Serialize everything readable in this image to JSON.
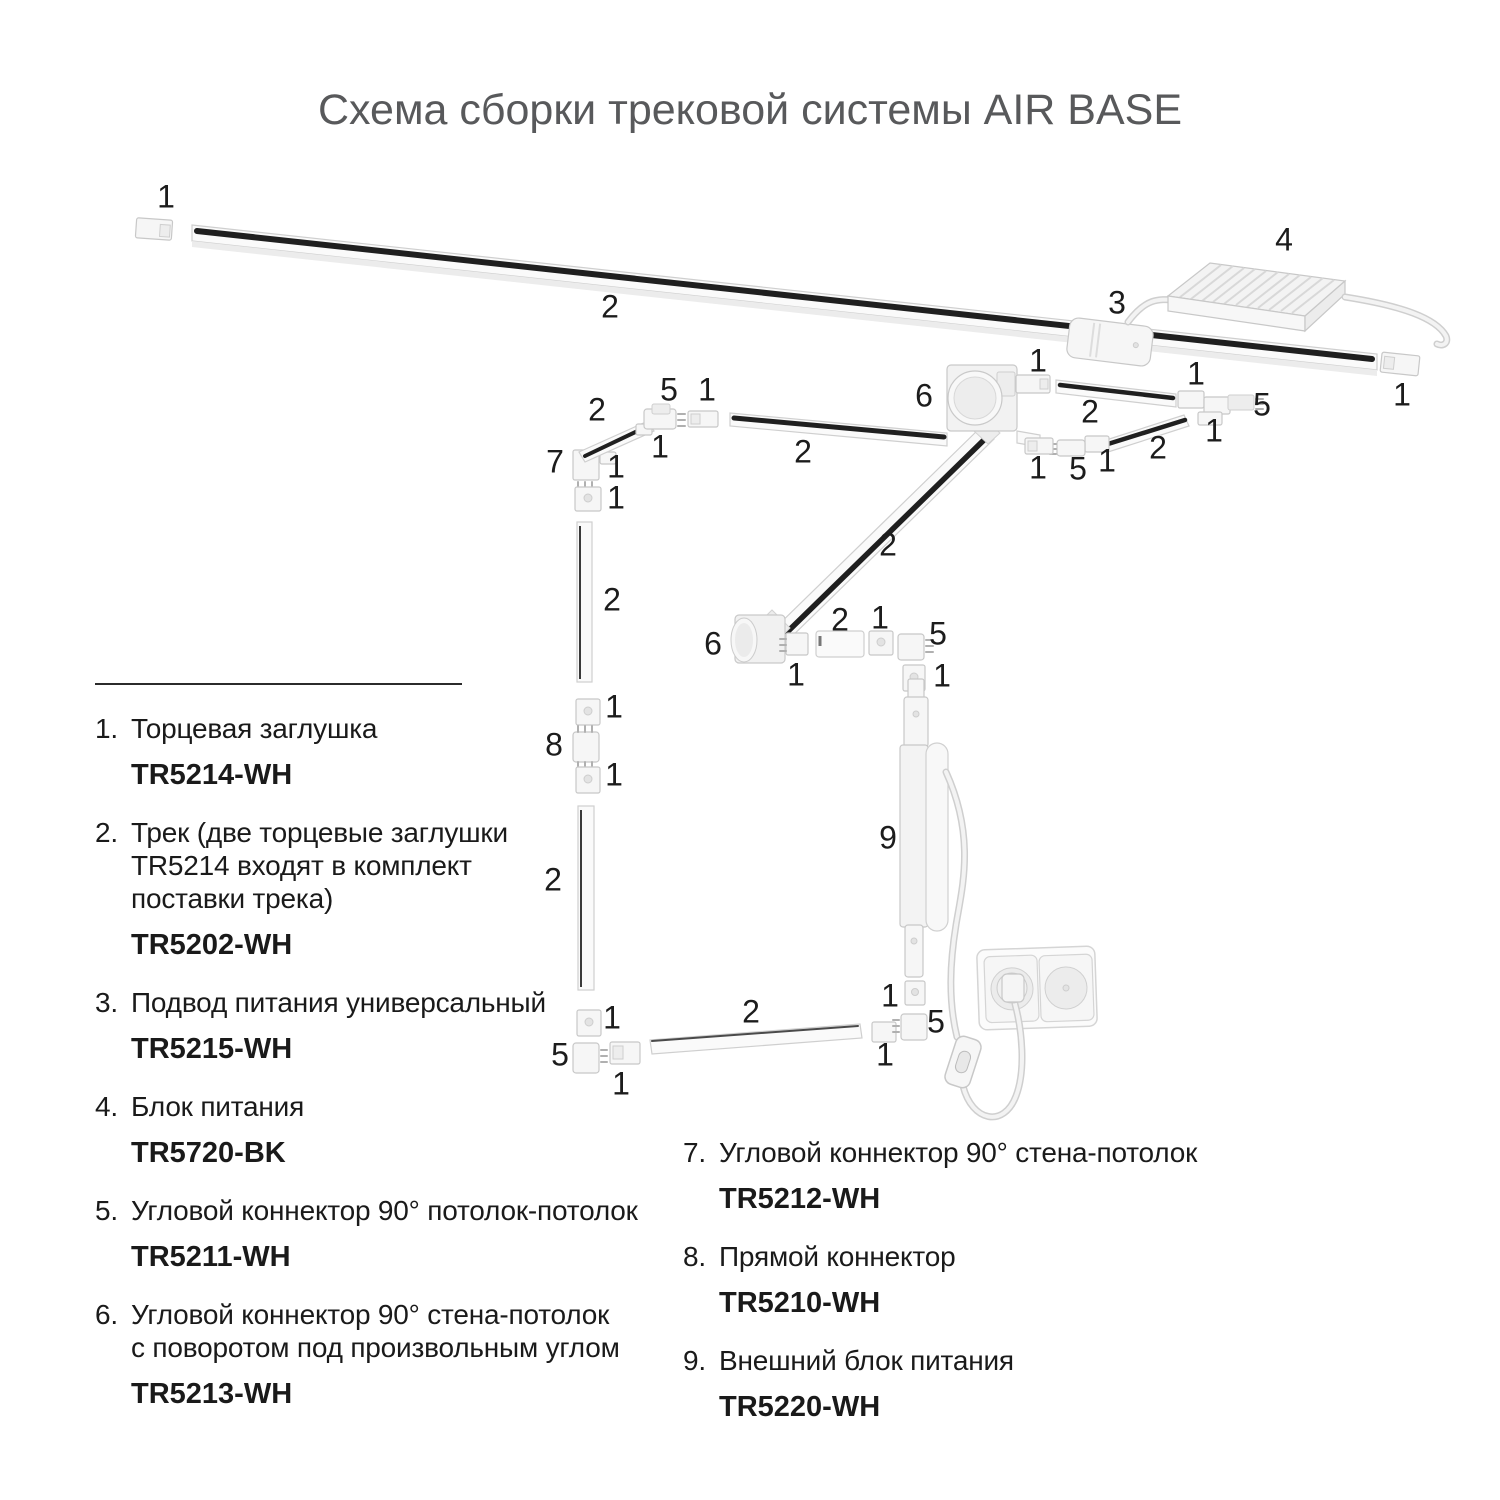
{
  "title": "Схема сборки трековой системы AIR BASE",
  "legend": {
    "left": [
      {
        "num": "1.",
        "lines": [
          "Торцевая заглушка"
        ],
        "code": "TR5214-WH"
      },
      {
        "num": "2.",
        "lines": [
          "Трек (две торцевые заглушки",
          "TR5214 входят в комплект",
          "поставки трека)"
        ],
        "code": "TR5202-WH"
      },
      {
        "num": "3.",
        "lines": [
          "Подвод питания универсальный"
        ],
        "code": "TR5215-WH"
      },
      {
        "num": "4.",
        "lines": [
          "Блок питания"
        ],
        "code": "TR5720-BK"
      },
      {
        "num": "5.",
        "lines": [
          "Угловой коннектор 90° потолок-потолок"
        ],
        "code": "TR5211-WH"
      },
      {
        "num": "6.",
        "lines": [
          "Угловой коннектор 90° стена-потолок",
          "с поворотом под произвольным углом"
        ],
        "code": "TR5213-WH"
      }
    ],
    "right": [
      {
        "num": "7.",
        "lines": [
          "Угловой коннектор 90° стена-потолок"
        ],
        "code": "TR5212-WH"
      },
      {
        "num": "8.",
        "lines": [
          "Прямой коннектор"
        ],
        "code": "TR5210-WH"
      },
      {
        "num": "9.",
        "lines": [
          "Внешний блок питания"
        ],
        "code": "TR5220-WH"
      }
    ]
  },
  "diagram": {
    "colors": {
      "stripe": "#1f1f1f",
      "part_fill": "#f6f6f6",
      "part_stroke": "#c8c8c8",
      "title_text": "#58595b",
      "body_text": "#1a1a1a"
    },
    "labels": [
      {
        "t": "1",
        "x": 166,
        "y": 197
      },
      {
        "t": "2",
        "x": 610,
        "y": 307
      },
      {
        "t": "3",
        "x": 1117,
        "y": 303
      },
      {
        "t": "4",
        "x": 1284,
        "y": 240
      },
      {
        "t": "1",
        "x": 1402,
        "y": 395
      },
      {
        "t": "2",
        "x": 597,
        "y": 410
      },
      {
        "t": "5",
        "x": 669,
        "y": 390
      },
      {
        "t": "1",
        "x": 707,
        "y": 390
      },
      {
        "t": "1",
        "x": 660,
        "y": 447
      },
      {
        "t": "7",
        "x": 555,
        "y": 462
      },
      {
        "t": "1",
        "x": 616,
        "y": 467
      },
      {
        "t": "1",
        "x": 616,
        "y": 498
      },
      {
        "t": "2",
        "x": 612,
        "y": 600
      },
      {
        "t": "1",
        "x": 614,
        "y": 707
      },
      {
        "t": "8",
        "x": 554,
        "y": 745
      },
      {
        "t": "1",
        "x": 614,
        "y": 775
      },
      {
        "t": "2",
        "x": 553,
        "y": 880
      },
      {
        "t": "1",
        "x": 612,
        "y": 1018
      },
      {
        "t": "5",
        "x": 560,
        "y": 1055
      },
      {
        "t": "1",
        "x": 621,
        "y": 1084
      },
      {
        "t": "2",
        "x": 751,
        "y": 1012
      },
      {
        "t": "1",
        "x": 885,
        "y": 1055
      },
      {
        "t": "5",
        "x": 936,
        "y": 1022
      },
      {
        "t": "1",
        "x": 890,
        "y": 996
      },
      {
        "t": "2",
        "x": 803,
        "y": 452
      },
      {
        "t": "6",
        "x": 924,
        "y": 396
      },
      {
        "t": "2",
        "x": 888,
        "y": 545
      },
      {
        "t": "6",
        "x": 713,
        "y": 644
      },
      {
        "t": "1",
        "x": 796,
        "y": 675
      },
      {
        "t": "2",
        "x": 840,
        "y": 620
      },
      {
        "t": "1",
        "x": 880,
        "y": 618
      },
      {
        "t": "5",
        "x": 938,
        "y": 634
      },
      {
        "t": "1",
        "x": 942,
        "y": 676
      },
      {
        "t": "9",
        "x": 888,
        "y": 838
      },
      {
        "t": "1",
        "x": 1038,
        "y": 361
      },
      {
        "t": "2",
        "x": 1090,
        "y": 412
      },
      {
        "t": "1",
        "x": 1196,
        "y": 374
      },
      {
        "t": "5",
        "x": 1262,
        "y": 405
      },
      {
        "t": "1",
        "x": 1214,
        "y": 431
      },
      {
        "t": "2",
        "x": 1158,
        "y": 448
      },
      {
        "t": "1",
        "x": 1107,
        "y": 461
      },
      {
        "t": "5",
        "x": 1078,
        "y": 469
      },
      {
        "t": "1",
        "x": 1038,
        "y": 468
      }
    ]
  }
}
